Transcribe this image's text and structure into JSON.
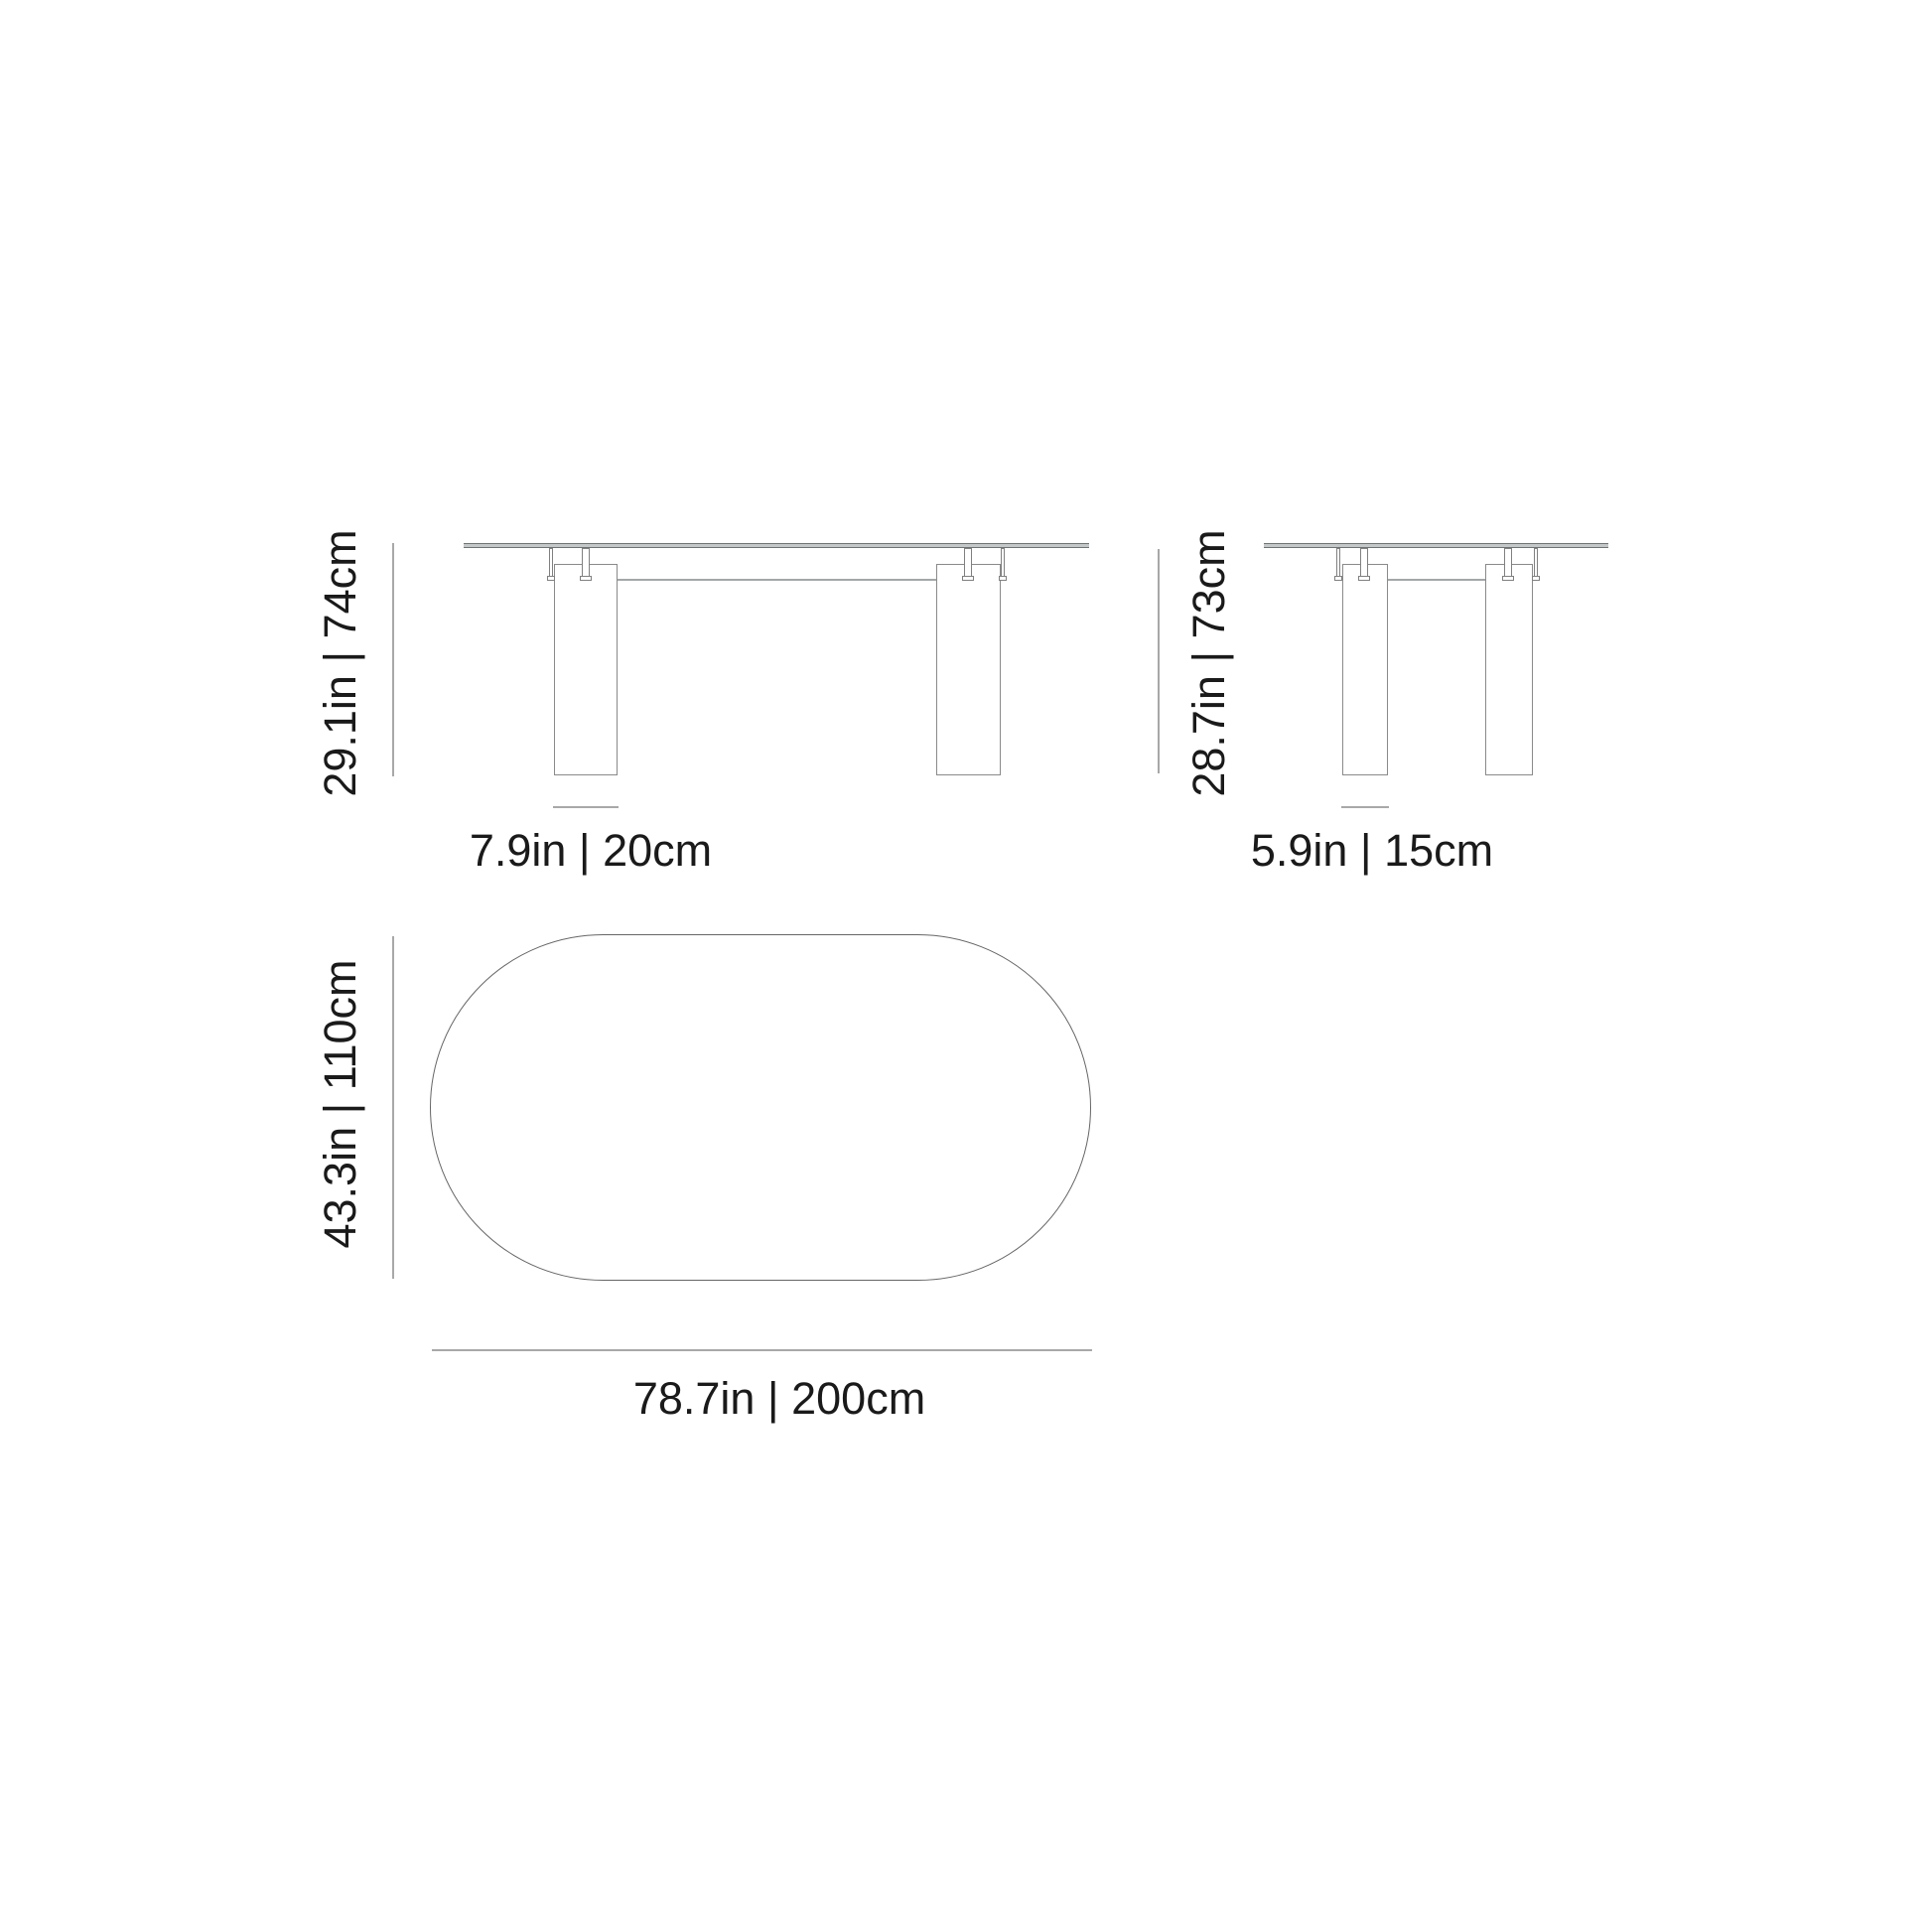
{
  "diagram": {
    "type": "furniture-dimension-drawing",
    "subject": "oval dining table with two column legs",
    "views": {
      "front": {
        "title": "front elevation",
        "height_label": "29.1in | 74cm",
        "leg_width_label": "7.9in | 20cm"
      },
      "side": {
        "title": "side elevation",
        "height_label": "28.7in | 73cm",
        "leg_depth_label": "5.9in | 15cm"
      },
      "top": {
        "title": "top plan (oval tabletop)",
        "depth_label": "43.3in | 110cm",
        "width_label": "78.7in | 200cm"
      }
    },
    "colors": {
      "background": "#ffffff",
      "text": "#1a1a1a",
      "dimension_line": "#a8a8a8",
      "furniture_outline": "#8a8a8a",
      "tabletop_fill": "#c5c8c8",
      "tabletop_edge": "#6f7374",
      "oval_outline": "#666666"
    }
  }
}
